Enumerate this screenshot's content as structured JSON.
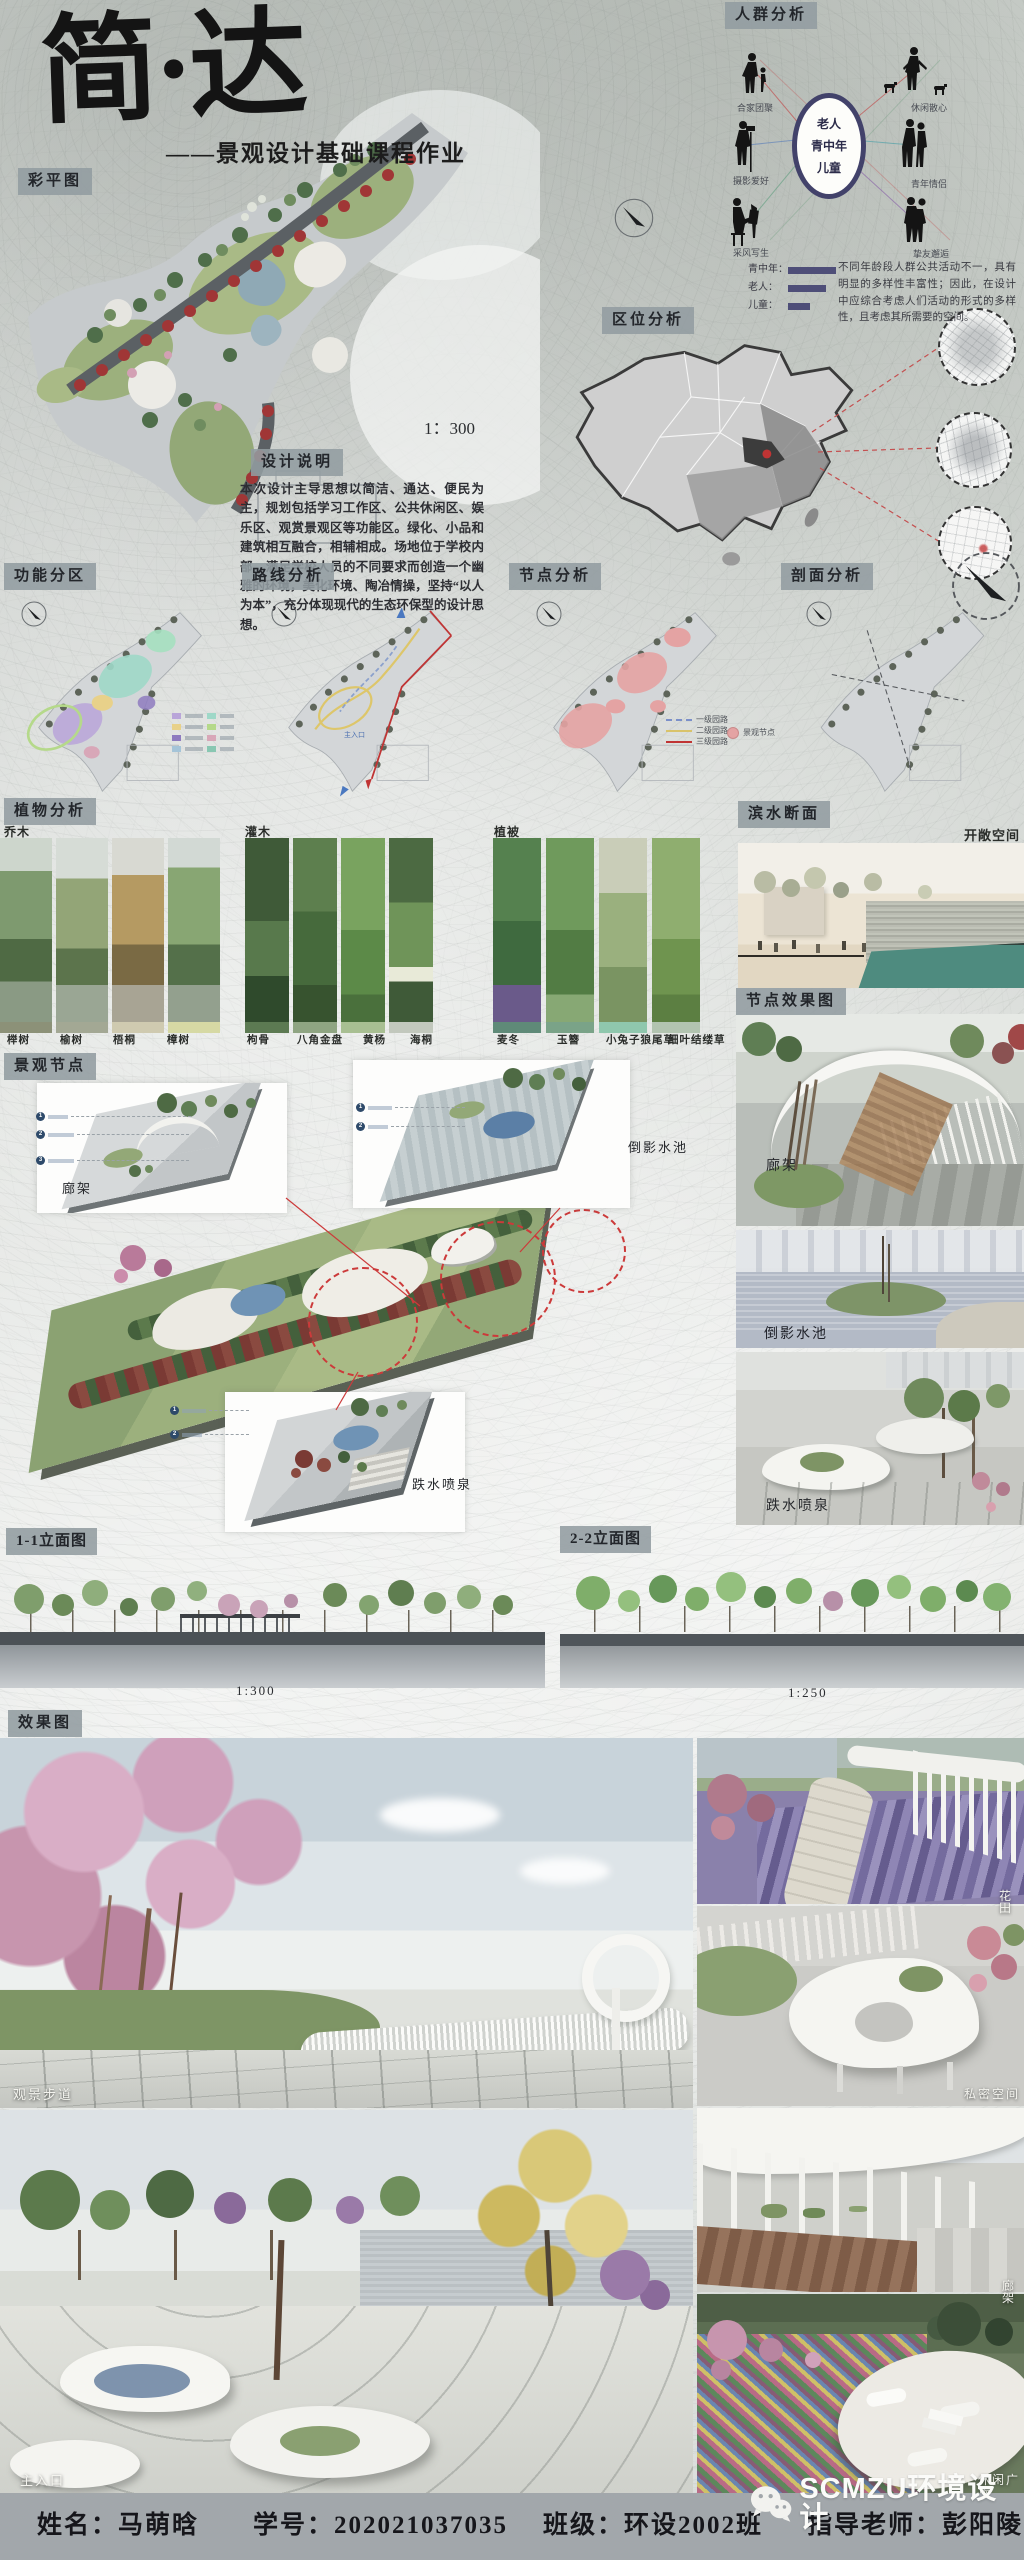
{
  "poster": {
    "title": "简·达",
    "subtitle": "——景观设计基础课程作业"
  },
  "plan": {
    "label": "彩平图",
    "scale": "1：300"
  },
  "crowd": {
    "label": "人群分析",
    "center_groups": [
      "老人",
      "青中年",
      "儿童"
    ],
    "figures": [
      {
        "name": "合家团聚"
      },
      {
        "name": "摄影爱好"
      },
      {
        "name": "采风写生"
      },
      {
        "name": "休闲散心"
      },
      {
        "name": "青年情侣"
      },
      {
        "name": "挚友邂逅"
      }
    ],
    "legend": [
      {
        "label": "青中年："
      },
      {
        "label": "老人："
      },
      {
        "label": "儿童："
      }
    ],
    "note": "不同年龄段人群公共活动不一，具有明显的多样性丰富性；因此，在设计中应综合考虑人们活动的形式的多样性，且考虑其所需要的空间。"
  },
  "location": {
    "label": "区位分析"
  },
  "design_note": {
    "label": "设计说明",
    "text": "本次设计主导思想以简洁、通达、便民为主，规划包括学习工作区、公共休闲区、娱乐区、观赏景观区等功能区。绿化、小品和建筑相互融合，相辅相成。场地位于学校内部，满足学校人员的不同要求而创造一个幽雅的环境，美化环境、陶冶情操，坚持“以人为本”，充分体现现代的生态环保型的设计思想。"
  },
  "analysis": {
    "panels": [
      {
        "label": "功能分区"
      },
      {
        "label": "路线分析"
      },
      {
        "label": "节点分析"
      },
      {
        "label": "剖面分析"
      }
    ],
    "route_legend": [
      {
        "label": "一级园路"
      },
      {
        "label": "二级园路"
      },
      {
        "label": "三级园路"
      }
    ],
    "node_legend": "景观节点",
    "entry_label": "主入口"
  },
  "plants": {
    "label": "植物分析",
    "groups": [
      {
        "title": "乔木",
        "items": [
          "榉树",
          "榆树",
          "梧桐",
          "樟树"
        ]
      },
      {
        "title": "灌木",
        "items": [
          "枸骨",
          "八角金盘",
          "黄杨",
          "海桐"
        ]
      },
      {
        "title": "植被",
        "items": [
          "麦冬",
          "玉簪",
          "小兔子狼尾草",
          "细叶结缕草"
        ]
      }
    ]
  },
  "waterfront": {
    "label": "滨水断面",
    "annotation": "开敞空间"
  },
  "node_renders": {
    "label": "节点效果图",
    "items": [
      "廊架",
      "倒影水池",
      "跌水喷泉"
    ]
  },
  "landscape_nodes": {
    "label": "景观节点",
    "axon_labels": [
      "廊架",
      "倒影水池",
      "跌水喷泉"
    ]
  },
  "elevations": [
    {
      "label": "1-1立面图",
      "scale": "1:300"
    },
    {
      "label": "2-2立面图",
      "scale": "1:250"
    }
  ],
  "renders": {
    "label": "效果图",
    "items": [
      "观景步道",
      "花田",
      "私密空间",
      "主入口",
      "廊架",
      "休闲广场"
    ]
  },
  "footer": {
    "name": "姓名：马萌晗",
    "student_id": "学号：202021037035",
    "class_name": "班级：环设2002班",
    "teacher": "指导老师：彭阳陵",
    "watermark": "SCMZU环境设计"
  },
  "colors": {
    "label_box": "#949ca1",
    "footer_bar": "#a2a7ab",
    "legend_bar": "#4e4e78",
    "accent_red": "#c03434",
    "teal_water": "#4e8b7f"
  }
}
